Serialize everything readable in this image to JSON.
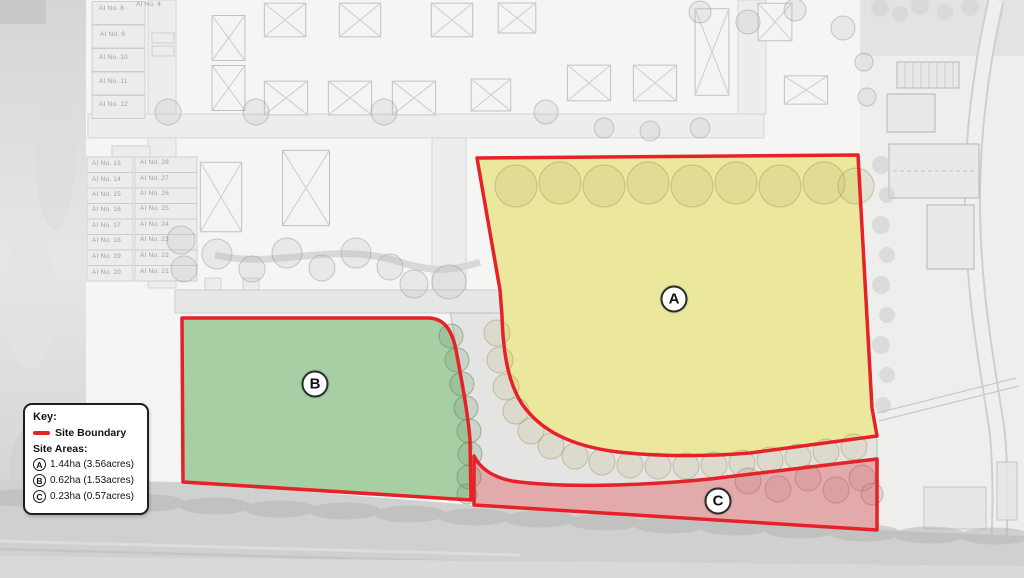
{
  "legend": {
    "title": "Key:",
    "site_boundary_label": "Site Boundary",
    "site_areas_label": "Site Areas:",
    "areas": [
      {
        "letter": "A",
        "value": "1.44ha (3.56acres)"
      },
      {
        "letter": "B",
        "value": "0.62ha (1.53acres)"
      },
      {
        "letter": "C",
        "value": "0.23ha (0.57acres)"
      }
    ]
  },
  "map": {
    "markers": [
      {
        "letter": "A",
        "x": 674,
        "y": 299
      },
      {
        "letter": "B",
        "x": 315,
        "y": 384
      },
      {
        "letter": "C",
        "x": 718,
        "y": 501
      }
    ],
    "plot_labels": [
      {
        "text": "AI No. 4",
        "x": 136,
        "y": 2
      },
      {
        "text": "AI No. 8",
        "x": 99,
        "y": 6
      },
      {
        "text": "AI No. 9",
        "x": 100,
        "y": 32
      },
      {
        "text": "AI No. 10",
        "x": 99,
        "y": 55
      },
      {
        "text": "AI No. 11",
        "x": 99,
        "y": 79
      },
      {
        "text": "AI No. 12",
        "x": 99,
        "y": 102
      },
      {
        "text": "AI No. 13",
        "x": 92,
        "y": 161
      },
      {
        "text": "AI No. 14",
        "x": 92,
        "y": 177
      },
      {
        "text": "AI No. 15",
        "x": 92,
        "y": 192
      },
      {
        "text": "AI No. 16",
        "x": 92,
        "y": 207
      },
      {
        "text": "AI No. 17",
        "x": 92,
        "y": 223
      },
      {
        "text": "AI No. 18",
        "x": 92,
        "y": 238
      },
      {
        "text": "AI No. 19",
        "x": 92,
        "y": 254
      },
      {
        "text": "AI No. 20",
        "x": 92,
        "y": 270
      },
      {
        "text": "AI No. 28",
        "x": 140,
        "y": 160
      },
      {
        "text": "AI No. 27",
        "x": 140,
        "y": 176
      },
      {
        "text": "AI No. 26",
        "x": 140,
        "y": 191
      },
      {
        "text": "AI No. 25",
        "x": 140,
        "y": 206
      },
      {
        "text": "AI No. 24",
        "x": 140,
        "y": 222
      },
      {
        "text": "AI No. 23",
        "x": 140,
        "y": 237
      },
      {
        "text": "AI No. 22",
        "x": 140,
        "y": 253
      },
      {
        "text": "AI No. 21",
        "x": 140,
        "y": 269
      }
    ],
    "colors": {
      "site_boundary": "#e62128",
      "area_a_fill": "#ebe79c",
      "area_b_fill": "#a8cea4",
      "area_c_fill": "#e3aaac"
    }
  }
}
